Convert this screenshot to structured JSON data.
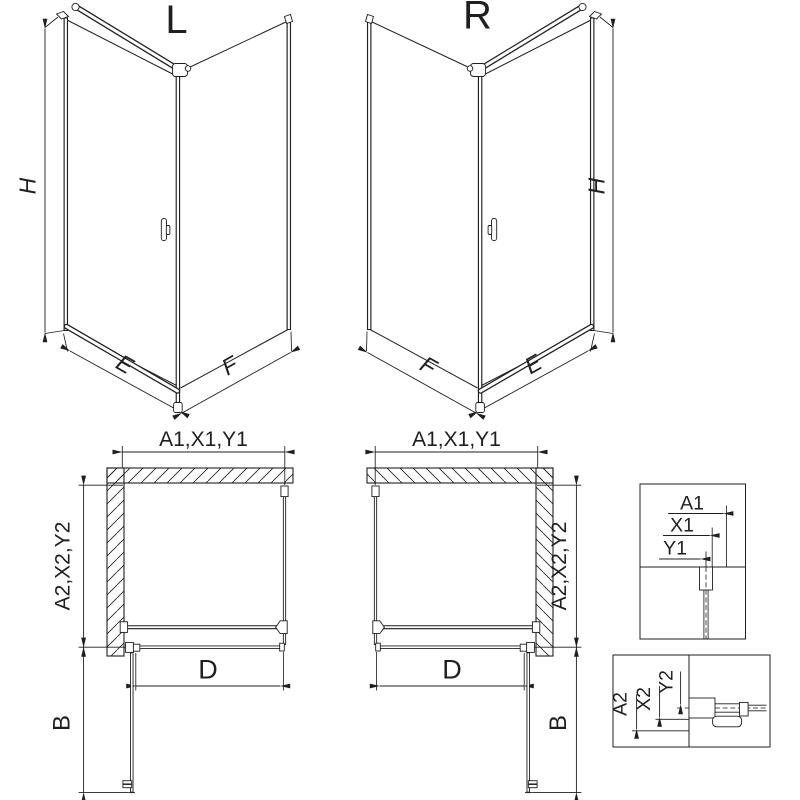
{
  "drawing": {
    "background": "#ffffff",
    "line_color": "#1f1f1f",
    "views": {
      "perspective_left": {
        "label": "L"
      },
      "perspective_right": {
        "label": "R"
      }
    },
    "dim_labels": {
      "height": "H",
      "door_side_width": "E",
      "fixed_side_width": "F",
      "total_width": "A1,X1,Y1",
      "total_depth": "A2,X2,Y2",
      "door_glass_width": "D",
      "door_opening": "B"
    },
    "detail_width": {
      "a1": "A1",
      "x1": "X1",
      "y1": "Y1"
    },
    "detail_depth": {
      "a2": "A2",
      "x2": "X2",
      "y2": "Y2"
    }
  }
}
